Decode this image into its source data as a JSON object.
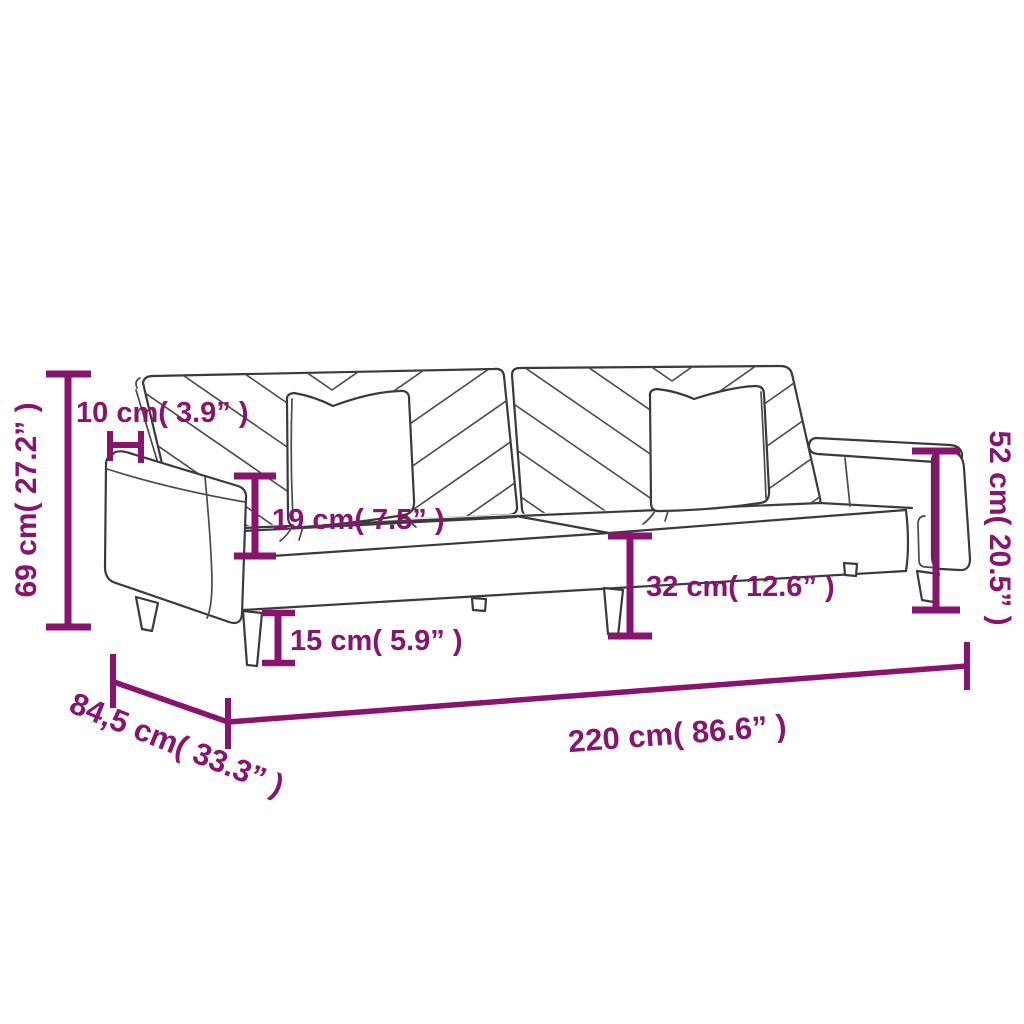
{
  "diagram": {
    "subject": "sofa-bed-dimension-diagram",
    "colors": {
      "dimension_accent": "#8A1370",
      "line_art": "#3A3A3A",
      "background": "#FFFFFF"
    },
    "measurements": {
      "total_height": "69 cm( 27.2” )",
      "backrest_offset": "10 cm( 3.9” )",
      "armrest_above_seat": "19 cm( 7.5” )",
      "leg_height": "15 cm( 5.9” )",
      "seat_height": "32 cm( 12.6” )",
      "armrest_height": "52 cm( 20.5” )",
      "total_width": "220 cm( 86.6” )",
      "total_depth": "84,5 cm( 33.3” )"
    }
  }
}
